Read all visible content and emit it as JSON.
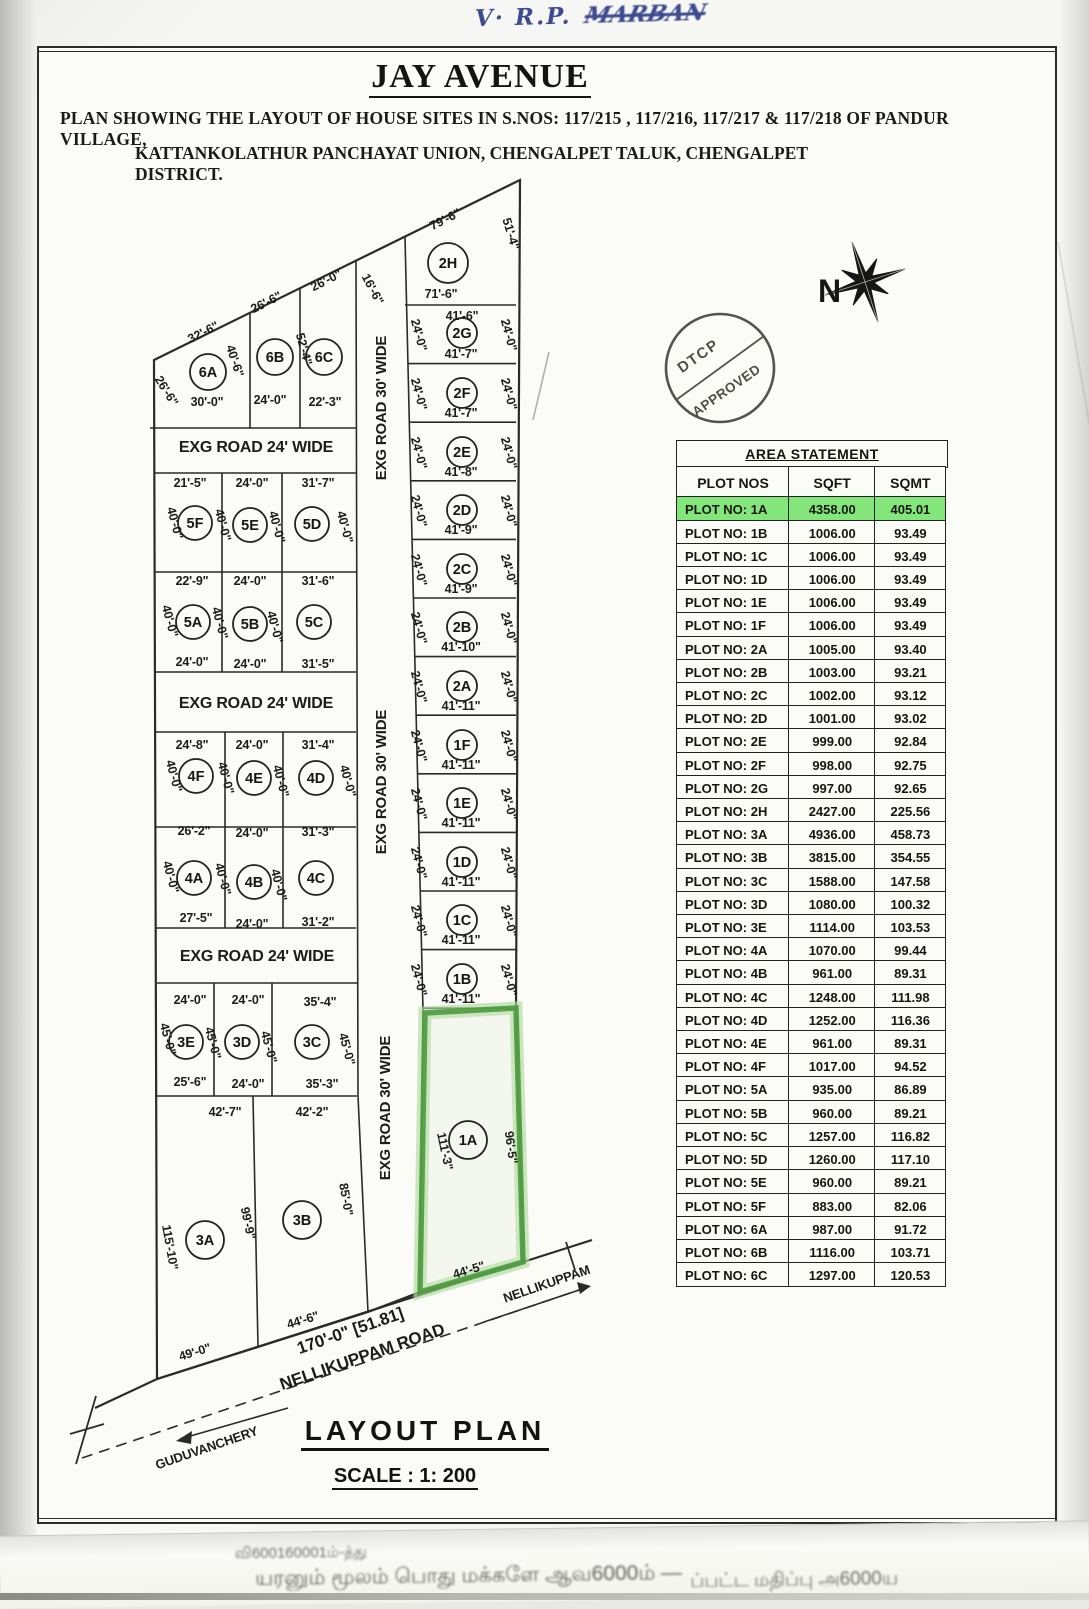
{
  "page": {
    "handwriting_prefix": "V· R.P.",
    "handwriting_name": "MARBAN",
    "title": "JAY AVENUE",
    "subtitle1": "PLAN SHOWING THE LAYOUT OF HOUSE SITES  IN S.NOS: 117/215 , 117/216, 117/217 & 117/218 OF  PANDUR VILLAGE,",
    "subtitle2": "KATTANKOLATHUR PANCHAYAT UNION, CHENGALPET TALUK, CHENGALPET DISTRICT.",
    "footer_title": "LAYOUT PLAN",
    "footer_scale": "SCALE : 1: 200",
    "bottom_strip_line1": "வி600160001ம்-த்து",
    "bottom_strip_line2": "யரனும் மூலம் பொது மக்களே ஆவ6000ம் —",
    "bottom_strip_line3": "ப்பட்ட மதிப்பு அ6000ய"
  },
  "compass": {
    "label": "N"
  },
  "stamp": {
    "line1": "DTCP",
    "line2": "APPROVED"
  },
  "colors": {
    "ink": "#22221f",
    "highlight_green": "#83e67b",
    "plot_outline_green": "#4d9a3f",
    "blue_ink": "#3d4b90"
  },
  "table": {
    "title": "AREA STATEMENT",
    "headers": [
      "PLOT NOS",
      "SQFT",
      "SQMT"
    ],
    "rows": [
      {
        "plot": "PLOT NO: 1A",
        "sqft": "4358.00",
        "sqmt": "405.01",
        "highlight": true
      },
      {
        "plot": "PLOT NO: 1B",
        "sqft": "1006.00",
        "sqmt": "93.49",
        "highlight": false
      },
      {
        "plot": "PLOT NO: 1C",
        "sqft": "1006.00",
        "sqmt": "93.49",
        "highlight": false
      },
      {
        "plot": "PLOT NO: 1D",
        "sqft": "1006.00",
        "sqmt": "93.49",
        "highlight": false
      },
      {
        "plot": "PLOT NO: 1E",
        "sqft": "1006.00",
        "sqmt": "93.49",
        "highlight": false
      },
      {
        "plot": "PLOT NO: 1F",
        "sqft": "1006.00",
        "sqmt": "93.49",
        "highlight": false
      },
      {
        "plot": "PLOT NO: 2A",
        "sqft": "1005.00",
        "sqmt": "93.40",
        "highlight": false
      },
      {
        "plot": "PLOT NO: 2B",
        "sqft": "1003.00",
        "sqmt": "93.21",
        "highlight": false
      },
      {
        "plot": "PLOT NO: 2C",
        "sqft": "1002.00",
        "sqmt": "93.12",
        "highlight": false
      },
      {
        "plot": "PLOT NO: 2D",
        "sqft": "1001.00",
        "sqmt": "93.02",
        "highlight": false
      },
      {
        "plot": "PLOT NO: 2E",
        "sqft": "999.00",
        "sqmt": "92.84",
        "highlight": false
      },
      {
        "plot": "PLOT NO: 2F",
        "sqft": "998.00",
        "sqmt": "92.75",
        "highlight": false
      },
      {
        "plot": "PLOT NO: 2G",
        "sqft": "997.00",
        "sqmt": "92.65",
        "highlight": false
      },
      {
        "plot": "PLOT NO: 2H",
        "sqft": "2427.00",
        "sqmt": "225.56",
        "highlight": false
      },
      {
        "plot": "PLOT NO: 3A",
        "sqft": "4936.00",
        "sqmt": "458.73",
        "highlight": false
      },
      {
        "plot": "PLOT NO: 3B",
        "sqft": "3815.00",
        "sqmt": "354.55",
        "highlight": false
      },
      {
        "plot": "PLOT NO: 3C",
        "sqft": "1588.00",
        "sqmt": "147.58",
        "highlight": false
      },
      {
        "plot": "PLOT NO: 3D",
        "sqft": "1080.00",
        "sqmt": "100.32",
        "highlight": false
      },
      {
        "plot": "PLOT NO: 3E",
        "sqft": "1114.00",
        "sqmt": "103.53",
        "highlight": false
      },
      {
        "plot": "PLOT NO: 4A",
        "sqft": "1070.00",
        "sqmt": "99.44",
        "highlight": false
      },
      {
        "plot": "PLOT NO: 4B",
        "sqft": "961.00",
        "sqmt": "89.31",
        "highlight": false
      },
      {
        "plot": "PLOT NO: 4C",
        "sqft": "1248.00",
        "sqmt": "111.98",
        "highlight": false
      },
      {
        "plot": "PLOT NO: 4D",
        "sqft": "1252.00",
        "sqmt": "116.36",
        "highlight": false
      },
      {
        "plot": "PLOT NO: 4E",
        "sqft": "961.00",
        "sqmt": "89.31",
        "highlight": false
      },
      {
        "plot": "PLOT NO: 4F",
        "sqft": "1017.00",
        "sqmt": "94.52",
        "highlight": false
      },
      {
        "plot": "PLOT NO: 5A",
        "sqft": "935.00",
        "sqmt": "86.89",
        "highlight": false
      },
      {
        "plot": "PLOT NO: 5B",
        "sqft": "960.00",
        "sqmt": "89.21",
        "highlight": false
      },
      {
        "plot": "PLOT NO: 5C",
        "sqft": "1257.00",
        "sqmt": "116.82",
        "highlight": false
      },
      {
        "plot": "PLOT NO: 5D",
        "sqft": "1260.00",
        "sqmt": "117.10",
        "highlight": false
      },
      {
        "plot": "PLOT NO: 5E",
        "sqft": "960.00",
        "sqmt": "89.21",
        "highlight": false
      },
      {
        "plot": "PLOT NO: 5F",
        "sqft": "883.00",
        "sqmt": "82.06",
        "highlight": false
      },
      {
        "plot": "PLOT NO: 6A",
        "sqft": "987.00",
        "sqmt": "91.72",
        "highlight": false
      },
      {
        "plot": "PLOT NO: 6B",
        "sqft": "1116.00",
        "sqmt": "103.71",
        "highlight": false
      },
      {
        "plot": "PLOT NO: 6C",
        "sqft": "1297.00",
        "sqmt": "120.53",
        "highlight": false
      }
    ]
  },
  "map": {
    "plots": [
      {
        "id": "6A",
        "x": 208,
        "y": 372,
        "r": 18
      },
      {
        "id": "6B",
        "x": 275,
        "y": 357,
        "r": 18
      },
      {
        "id": "6C",
        "x": 324,
        "y": 357,
        "r": 18
      },
      {
        "id": "2H",
        "x": 448,
        "y": 263,
        "r": 20
      },
      {
        "id": "2G",
        "x": 462,
        "y": 333,
        "r": 15
      },
      {
        "id": "2F",
        "x": 462,
        "y": 393,
        "r": 15
      },
      {
        "id": "2E",
        "x": 462,
        "y": 452,
        "r": 15
      },
      {
        "id": "2D",
        "x": 462,
        "y": 510,
        "r": 15
      },
      {
        "id": "2C",
        "x": 462,
        "y": 569,
        "r": 15
      },
      {
        "id": "2B",
        "x": 462,
        "y": 627,
        "r": 15
      },
      {
        "id": "2A",
        "x": 462,
        "y": 686,
        "r": 15
      },
      {
        "id": "1F",
        "x": 462,
        "y": 745,
        "r": 15
      },
      {
        "id": "1E",
        "x": 462,
        "y": 803,
        "r": 15
      },
      {
        "id": "1D",
        "x": 462,
        "y": 862,
        "r": 15
      },
      {
        "id": "1C",
        "x": 462,
        "y": 920,
        "r": 15
      },
      {
        "id": "1B",
        "x": 462,
        "y": 979,
        "r": 15
      },
      {
        "id": "5F",
        "x": 195,
        "y": 523,
        "r": 17
      },
      {
        "id": "5E",
        "x": 250,
        "y": 525,
        "r": 17
      },
      {
        "id": "5D",
        "x": 312,
        "y": 524,
        "r": 17
      },
      {
        "id": "5A",
        "x": 193,
        "y": 622,
        "r": 17
      },
      {
        "id": "5B",
        "x": 250,
        "y": 624,
        "r": 17
      },
      {
        "id": "5C",
        "x": 314,
        "y": 622,
        "r": 17
      },
      {
        "id": "4F",
        "x": 196,
        "y": 776,
        "r": 17
      },
      {
        "id": "4E",
        "x": 254,
        "y": 778,
        "r": 17
      },
      {
        "id": "4D",
        "x": 316,
        "y": 778,
        "r": 17
      },
      {
        "id": "4A",
        "x": 194,
        "y": 878,
        "r": 17
      },
      {
        "id": "4B",
        "x": 254,
        "y": 882,
        "r": 17
      },
      {
        "id": "4C",
        "x": 316,
        "y": 878,
        "r": 17
      },
      {
        "id": "3E",
        "x": 186,
        "y": 1042,
        "r": 17
      },
      {
        "id": "3D",
        "x": 242,
        "y": 1042,
        "r": 17
      },
      {
        "id": "3C",
        "x": 312,
        "y": 1042,
        "r": 17
      },
      {
        "id": "3A",
        "x": 205,
        "y": 1240,
        "r": 19
      },
      {
        "id": "3B",
        "x": 302,
        "y": 1220,
        "r": 19
      },
      {
        "id": "1A",
        "x": 468,
        "y": 1140,
        "r": 19
      }
    ],
    "labels": [
      {
        "t": "EXG ROAD 24' WIDE",
        "x": 256,
        "y": 452,
        "s": 16
      },
      {
        "t": "EXG ROAD 24' WIDE",
        "x": 256,
        "y": 708,
        "s": 16
      },
      {
        "t": "EXG ROAD 24' WIDE",
        "x": 257,
        "y": 961,
        "s": 16
      },
      {
        "t": "EXG ROAD 30' WIDE",
        "x": 386,
        "y": 408,
        "r": -90,
        "s": 15
      },
      {
        "t": "EXG ROAD 30' WIDE",
        "x": 386,
        "y": 782,
        "r": -90,
        "s": 15
      },
      {
        "t": "EXG ROAD 30' WIDE",
        "x": 390,
        "y": 1108,
        "r": -90,
        "s": 15
      },
      {
        "t": "32'-6\"",
        "x": 205,
        "y": 336,
        "r": -27
      },
      {
        "t": "26'-6\"",
        "x": 268,
        "y": 306,
        "r": -27
      },
      {
        "t": "26'-0\"",
        "x": 328,
        "y": 284,
        "r": -27
      },
      {
        "t": "26'-6\"",
        "x": 163,
        "y": 393,
        "r": 58
      },
      {
        "t": "40'-6\"",
        "x": 231,
        "y": 362,
        "r": 72
      },
      {
        "t": "30'-0\"",
        "x": 207,
        "y": 406
      },
      {
        "t": "52'-4\"",
        "x": 300,
        "y": 350,
        "r": 75
      },
      {
        "t": "24'-0\"",
        "x": 270,
        "y": 404
      },
      {
        "t": "22'-3\"",
        "x": 325,
        "y": 406
      },
      {
        "t": "16'-6\"",
        "x": 369,
        "y": 291,
        "r": 62
      },
      {
        "t": "79'-6\"",
        "x": 447,
        "y": 223,
        "r": -27
      },
      {
        "t": "51'-4\"",
        "x": 507,
        "y": 235,
        "r": 73
      },
      {
        "t": "71'-6\"",
        "x": 441,
        "y": 298
      },
      {
        "t": "41'-6\"",
        "x": 462,
        "y": 320
      },
      {
        "t": "41'-7\"",
        "x": 461,
        "y": 358
      },
      {
        "t": "41'-7\"",
        "x": 461,
        "y": 417
      },
      {
        "t": "41'-8\"",
        "x": 461,
        "y": 476
      },
      {
        "t": "41'-9\"",
        "x": 461,
        "y": 534
      },
      {
        "t": "41'-9\"",
        "x": 461,
        "y": 593
      },
      {
        "t": "41'-10\"",
        "x": 461,
        "y": 651
      },
      {
        "t": "41'-11\"",
        "x": 461,
        "y": 710
      },
      {
        "t": "41'-11\"",
        "x": 461,
        "y": 769
      },
      {
        "t": "41'-11\"",
        "x": 461,
        "y": 827
      },
      {
        "t": "41'-11\"",
        "x": 461,
        "y": 886
      },
      {
        "t": "41'-11\"",
        "x": 461,
        "y": 944
      },
      {
        "t": "41'-11\"",
        "x": 461,
        "y": 1003
      },
      {
        "t": "24'-0\"",
        "x": 415,
        "y": 336,
        "r": 75
      },
      {
        "t": "24'-0\"",
        "x": 505,
        "y": 336,
        "r": 75
      },
      {
        "t": "24'-0\"",
        "x": 415,
        "y": 395,
        "r": 75
      },
      {
        "t": "24'-0\"",
        "x": 505,
        "y": 395,
        "r": 75
      },
      {
        "t": "24'-0\"",
        "x": 415,
        "y": 454,
        "r": 75
      },
      {
        "t": "24'-0\"",
        "x": 505,
        "y": 454,
        "r": 75
      },
      {
        "t": "24'-0\"",
        "x": 415,
        "y": 512,
        "r": 75
      },
      {
        "t": "24'-0\"",
        "x": 505,
        "y": 512,
        "r": 75
      },
      {
        "t": "24'-0\"",
        "x": 415,
        "y": 571,
        "r": 75
      },
      {
        "t": "24'-0\"",
        "x": 505,
        "y": 571,
        "r": 75
      },
      {
        "t": "24'-0\"",
        "x": 415,
        "y": 629,
        "r": 75
      },
      {
        "t": "24'-0\"",
        "x": 505,
        "y": 629,
        "r": 75
      },
      {
        "t": "24'-0\"",
        "x": 415,
        "y": 688,
        "r": 75
      },
      {
        "t": "24'-0\"",
        "x": 505,
        "y": 688,
        "r": 75
      },
      {
        "t": "24'-0\"",
        "x": 415,
        "y": 747,
        "r": 75
      },
      {
        "t": "24'-0\"",
        "x": 505,
        "y": 747,
        "r": 75
      },
      {
        "t": "24'-0\"",
        "x": 415,
        "y": 805,
        "r": 75
      },
      {
        "t": "24'-0\"",
        "x": 505,
        "y": 805,
        "r": 75
      },
      {
        "t": "24'-0\"",
        "x": 415,
        "y": 864,
        "r": 75
      },
      {
        "t": "24'-0\"",
        "x": 505,
        "y": 864,
        "r": 75
      },
      {
        "t": "24'-0\"",
        "x": 415,
        "y": 922,
        "r": 75
      },
      {
        "t": "24'-0\"",
        "x": 505,
        "y": 922,
        "r": 75
      },
      {
        "t": "24'-0\"",
        "x": 415,
        "y": 981,
        "r": 75
      },
      {
        "t": "24'-0\"",
        "x": 505,
        "y": 981,
        "r": 75
      },
      {
        "t": "21'-5\"",
        "x": 190,
        "y": 487
      },
      {
        "t": "24'-0\"",
        "x": 252,
        "y": 487
      },
      {
        "t": "31'-7\"",
        "x": 318,
        "y": 487
      },
      {
        "t": "40'-0\"",
        "x": 171,
        "y": 524,
        "r": 75
      },
      {
        "t": "40'-0\"",
        "x": 219,
        "y": 526,
        "r": 75
      },
      {
        "t": "40'-0\"",
        "x": 273,
        "y": 528,
        "r": 75
      },
      {
        "t": "40'-0\"",
        "x": 341,
        "y": 528,
        "r": 75
      },
      {
        "t": "22'-9\"",
        "x": 192,
        "y": 585
      },
      {
        "t": "24'-0\"",
        "x": 250,
        "y": 585
      },
      {
        "t": "31'-6\"",
        "x": 318,
        "y": 585
      },
      {
        "t": "40'-0\"",
        "x": 166,
        "y": 622,
        "r": 75
      },
      {
        "t": "40'-0\"",
        "x": 216,
        "y": 624,
        "r": 75
      },
      {
        "t": "40'-0\"",
        "x": 271,
        "y": 628,
        "r": 75
      },
      {
        "t": "24'-0\"",
        "x": 192,
        "y": 666
      },
      {
        "t": "24'-0\"",
        "x": 250,
        "y": 668
      },
      {
        "t": "31'-5\"",
        "x": 318,
        "y": 668
      },
      {
        "t": "24'-8\"",
        "x": 192,
        "y": 749
      },
      {
        "t": "24'-0\"",
        "x": 252,
        "y": 749
      },
      {
        "t": "31'-4\"",
        "x": 318,
        "y": 749
      },
      {
        "t": "40'-0\"",
        "x": 170,
        "y": 777,
        "r": 75
      },
      {
        "t": "40'-0\"",
        "x": 222,
        "y": 779,
        "r": 75
      },
      {
        "t": "40'-0\"",
        "x": 277,
        "y": 782,
        "r": 75
      },
      {
        "t": "40'-0\"",
        "x": 344,
        "y": 782,
        "r": 75
      },
      {
        "t": "26'-2\"",
        "x": 194,
        "y": 835
      },
      {
        "t": "24'-0\"",
        "x": 252,
        "y": 837
      },
      {
        "t": "31'-3\"",
        "x": 318,
        "y": 836
      },
      {
        "t": "40'-0\"",
        "x": 167,
        "y": 878,
        "r": 75
      },
      {
        "t": "40'-0\"",
        "x": 219,
        "y": 880,
        "r": 75
      },
      {
        "t": "40'-0\"",
        "x": 275,
        "y": 886,
        "r": 75
      },
      {
        "t": "27'-5\"",
        "x": 196,
        "y": 922
      },
      {
        "t": "24'-0\"",
        "x": 252,
        "y": 928
      },
      {
        "t": "31'-2\"",
        "x": 318,
        "y": 926
      },
      {
        "t": "24'-0\"",
        "x": 190,
        "y": 1004
      },
      {
        "t": "24'-0\"",
        "x": 248,
        "y": 1004
      },
      {
        "t": "35'-4\"",
        "x": 320,
        "y": 1006
      },
      {
        "t": "45'-0\"",
        "x": 164,
        "y": 1040,
        "r": 75
      },
      {
        "t": "45'-0\"",
        "x": 209,
        "y": 1044,
        "r": 75
      },
      {
        "t": "45'-0\"",
        "x": 265,
        "y": 1048,
        "r": 75
      },
      {
        "t": "45'-0\"",
        "x": 343,
        "y": 1050,
        "r": 75
      },
      {
        "t": "25'-6\"",
        "x": 190,
        "y": 1086
      },
      {
        "t": "24'-0\"",
        "x": 248,
        "y": 1088
      },
      {
        "t": "35'-3\"",
        "x": 322,
        "y": 1088
      },
      {
        "t": "42'-7\"",
        "x": 225,
        "y": 1116
      },
      {
        "t": "42'-2\"",
        "x": 312,
        "y": 1116
      },
      {
        "t": "115'-10\"",
        "x": 166,
        "y": 1248,
        "r": 80
      },
      {
        "t": "99'-9\"",
        "x": 244,
        "y": 1224,
        "r": 78
      },
      {
        "t": "85'-0\"",
        "x": 342,
        "y": 1200,
        "r": 80
      },
      {
        "t": "49'-0\"",
        "x": 196,
        "y": 1356,
        "r": -17
      },
      {
        "t": "44'-6\"",
        "x": 304,
        "y": 1324,
        "r": -17
      },
      {
        "t": "111'-3\"",
        "x": 441,
        "y": 1152,
        "r": 78
      },
      {
        "t": "96'-5\"",
        "x": 507,
        "y": 1148,
        "r": 82
      },
      {
        "t": "44'-5\"",
        "x": 470,
        "y": 1274,
        "r": -17
      },
      {
        "t": "170'-0\" [51.81]",
        "x": 352,
        "y": 1336,
        "r": -19,
        "s": 17
      },
      {
        "t": "NELLIKUPPAM ROAD",
        "x": 364,
        "y": 1362,
        "r": -19,
        "s": 17
      },
      {
        "t": "GUDUVANCHERY",
        "x": 208,
        "y": 1452,
        "r": -19,
        "s": 13
      },
      {
        "t": "NELLIKUPPAM",
        "x": 548,
        "y": 1288,
        "r": -19,
        "s": 13
      }
    ]
  }
}
